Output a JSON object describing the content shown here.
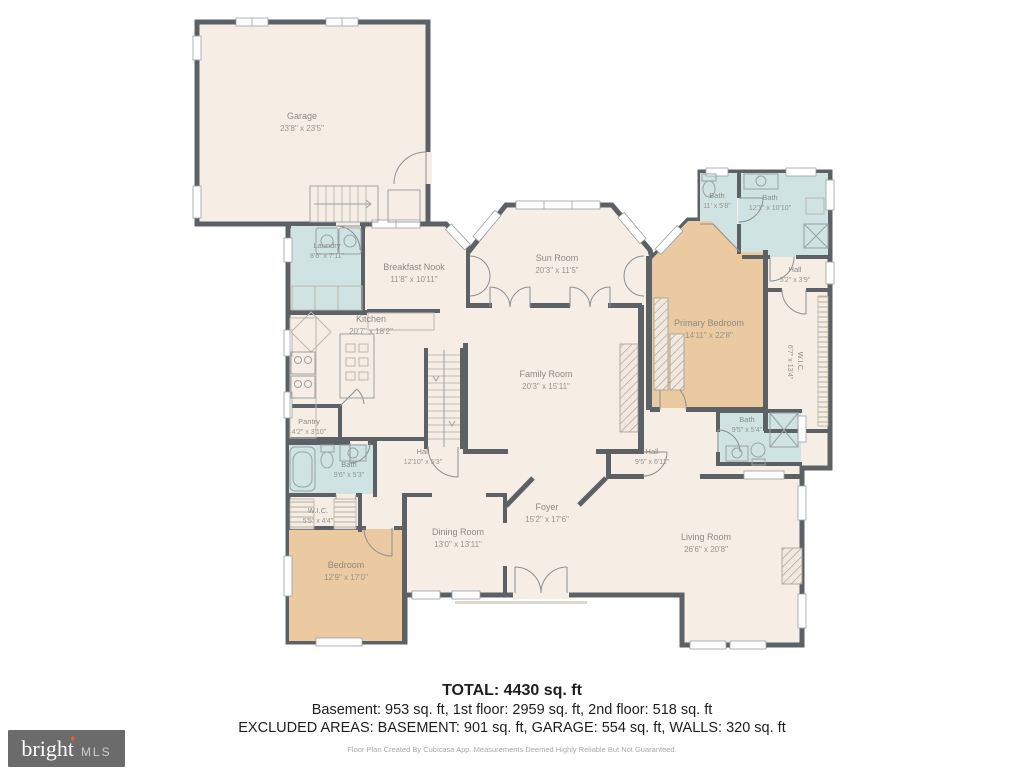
{
  "colors": {
    "wall": "#5c6166",
    "floor": "#f6eee5",
    "wet_room": "#cee3e2",
    "bedroom": "#ebc9a1",
    "label": "#8a8a83"
  },
  "rooms": {
    "garage": {
      "name": "Garage",
      "dims": "23'8\" x 23'5\""
    },
    "laundry": {
      "name": "Laundry",
      "dims": "8'6\" x 7'11\""
    },
    "breakfast_nook": {
      "name": "Breakfast Nook",
      "dims": "11'8\" x 10'11\""
    },
    "sun_room": {
      "name": "Sun Room",
      "dims": "20'3\" x 11'5\""
    },
    "kitchen": {
      "name": "Kitchen",
      "dims": "20'7\" x 18'2\""
    },
    "family_room": {
      "name": "Family Room",
      "dims": "20'3\" x 15'11\""
    },
    "bath_top_small": {
      "name": "Bath",
      "dims": "11' x 5'8\""
    },
    "bath_top_large": {
      "name": "Bath",
      "dims": "12'1\" x 10'10\""
    },
    "hall_upper_right": {
      "name": "Hall",
      "dims": "5'2\" x 3'9\""
    },
    "primary_bedroom": {
      "name": "Primary Bedroom",
      "dims": "14'11\" x 22'8\""
    },
    "wic_right": {
      "name": "W.I.C.",
      "dims": "6'7\" x 13'4\""
    },
    "pantry": {
      "name": "Pantry",
      "dims": "4'2\" x 3'10\""
    },
    "bath_left": {
      "name": "Bath",
      "dims": "9'6\" x 5'3\""
    },
    "hall_center": {
      "name": "Hall",
      "dims": "12'10\" x 5'3\""
    },
    "hall_right": {
      "name": "Hall",
      "dims": "9'5\" x 6'11\""
    },
    "bath_mid_right": {
      "name": "Bath",
      "dims": "9'5\" x 5'4\""
    },
    "wic_left": {
      "name": "W.I.C.",
      "dims": "5'5\" x 4'4\""
    },
    "bedroom": {
      "name": "Bedroom",
      "dims": "12'9\" x 17'0\""
    },
    "dining_room": {
      "name": "Dining Room",
      "dims": "13'0\" x 13'11\""
    },
    "foyer": {
      "name": "Foyer",
      "dims": "15'2\" x 17'6\""
    },
    "living_room": {
      "name": "Living Room",
      "dims": "26'6\" x 20'8\""
    }
  },
  "footer": {
    "total": "TOTAL: 4430 sq. ft",
    "floors": "Basement: 953 sq. ft, 1st floor: 2959 sq. ft, 2nd floor: 518 sq. ft",
    "excluded": "EXCLUDED AREAS: BASEMENT: 901 sq. ft, GARAGE: 554 sq. ft, WALLS: 320 sq. ft",
    "disclaimer": "Floor Plan Created By Cubicasa App. Measurements Deemed Highly Reliable But Not Guaranteed."
  },
  "logo": {
    "brand": "bright",
    "suffix": "MLS",
    "tm": "™",
    "star": "✦"
  }
}
